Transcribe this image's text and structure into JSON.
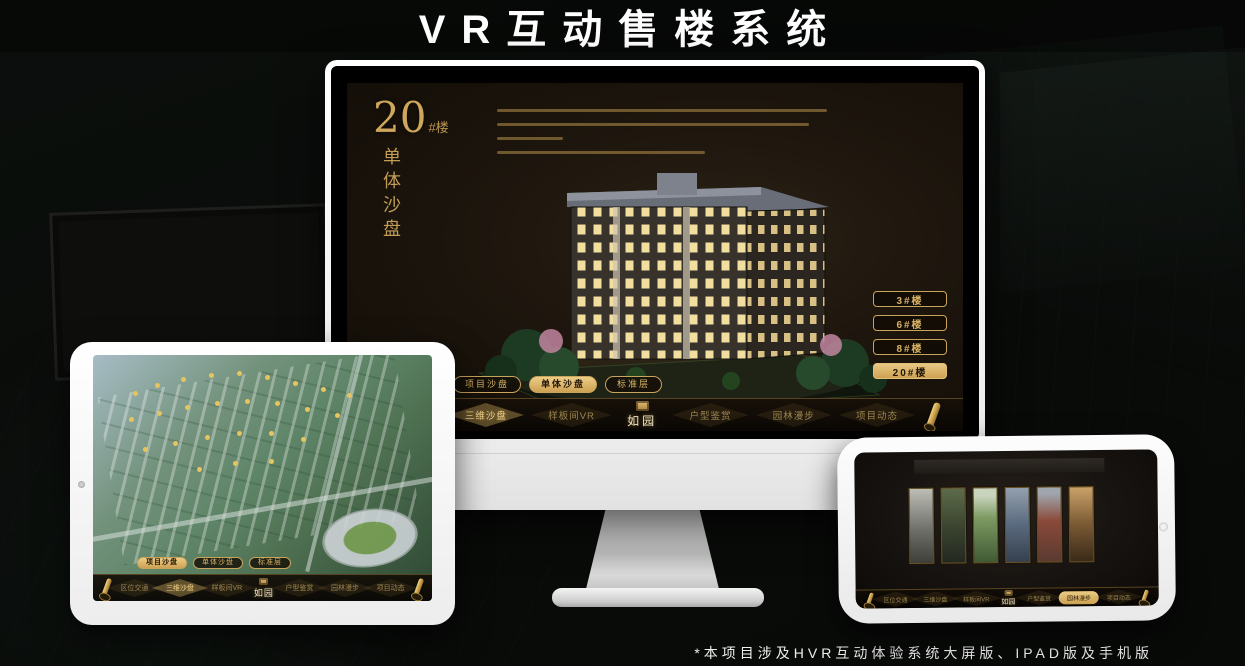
{
  "page": {
    "title": "VR互动售楼系统",
    "footnote": "*本项目涉及HVR互动体验系统大屏版、IPAD版及手机版"
  },
  "colors": {
    "gold": "#d8b264",
    "gold_bright": "#e8c45e",
    "screen_bg": "#1b140c"
  },
  "brand": {
    "logo": "如园"
  },
  "monitor": {
    "headline": {
      "number": "20",
      "suffix": "#楼",
      "vertical": "单体沙盘"
    },
    "building_buttons": [
      {
        "label": "3#楼",
        "active": false
      },
      {
        "label": "6#楼",
        "active": false
      },
      {
        "label": "8#楼",
        "active": false
      },
      {
        "label": "20#楼",
        "active": true
      }
    ],
    "tabs": [
      {
        "label": "项目沙盘",
        "active": false
      },
      {
        "label": "单体沙盘",
        "active": true
      },
      {
        "label": "标准层",
        "active": false
      }
    ],
    "nav": {
      "logo": "如园",
      "items": [
        {
          "label": "区位交通",
          "active": false
        },
        {
          "label": "三维沙盘",
          "active": true
        },
        {
          "label": "样板间VR",
          "active": false
        },
        {
          "label": "户型鉴赏",
          "active": false
        },
        {
          "label": "园林漫步",
          "active": false
        },
        {
          "label": "项目动态",
          "active": false
        }
      ]
    }
  },
  "tablet": {
    "tabs": [
      {
        "label": "项目沙盘",
        "active": true
      },
      {
        "label": "单体沙盘",
        "active": false
      },
      {
        "label": "标准层",
        "active": false
      }
    ],
    "nav": {
      "logo": "如园",
      "items": [
        {
          "label": "区位交通",
          "active": false
        },
        {
          "label": "三维沙盘",
          "active": true
        },
        {
          "label": "样板间VR",
          "active": false
        },
        {
          "label": "户型鉴赏",
          "active": false
        },
        {
          "label": "园林漫步",
          "active": false
        },
        {
          "label": "项目动态",
          "active": false
        }
      ]
    }
  },
  "phone": {
    "nav": {
      "logo": "如园",
      "items": [
        {
          "label": "区位交通",
          "active": false
        },
        {
          "label": "三维沙盘",
          "active": false
        },
        {
          "label": "样板间VR",
          "active": false
        },
        {
          "label": "户型鉴赏",
          "active": false
        },
        {
          "label": "园林漫步",
          "active": true
        },
        {
          "label": "项目动态",
          "active": false
        }
      ]
    }
  }
}
